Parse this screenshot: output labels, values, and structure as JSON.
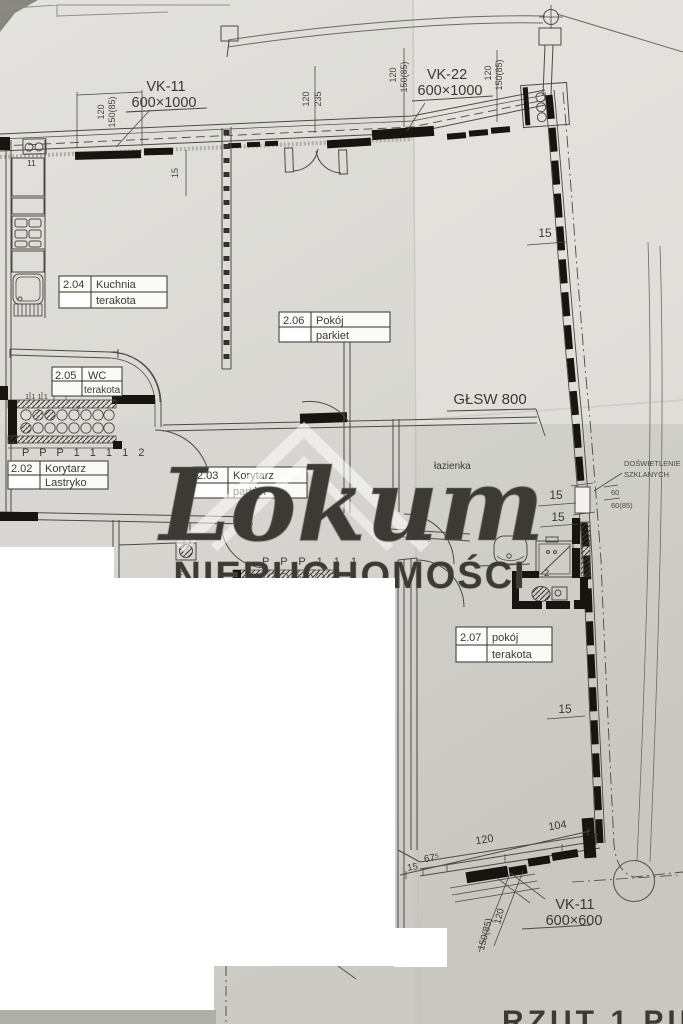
{
  "watermark": {
    "brand": "Lokum",
    "subtitle": "NIERUCHOMOŚCI"
  },
  "title": {
    "drawing_title": "RZUT 1 PIĘTRA"
  },
  "rooms": [
    {
      "id": "2.02",
      "name": "Korytarz",
      "floor": "Lastryko"
    },
    {
      "id": "2.03",
      "name": "Korytarz",
      "floor": "parkiet"
    },
    {
      "id": "2.04",
      "name": "Kuchnia",
      "floor": "terakota"
    },
    {
      "id": "2.05",
      "name": "WC",
      "floor": "terakota"
    },
    {
      "id": "2.06",
      "name": "Pokój",
      "floor": "parkiet"
    },
    {
      "id": "2.07",
      "name": "pokój",
      "floor": "terakota"
    }
  ],
  "bathroom_label": "łazienka",
  "vents": {
    "vk11_top": {
      "code": "VK-11",
      "size": "600×1000"
    },
    "vk22": {
      "code": "VK-22",
      "size": "600×1000"
    },
    "vk11_bottom": {
      "code": "VK-11",
      "size": "600×600"
    }
  },
  "annotations": {
    "glsw": "GŁSW 800",
    "daylight1": "DOŚWIETLENIE",
    "daylight2": "SZKLANYCH",
    "partial_text": "d.kl."
  },
  "dims": {
    "w120_a": "120",
    "w150_a": "150(85)",
    "w120_b": "120",
    "w235": "235",
    "w120_c": "120",
    "w150_c": "150(85)",
    "w120_d": "120",
    "w150_d": "150(85)",
    "v15_top": "15",
    "r15_1": "15",
    "r15_2": "15",
    "r15_3": "15",
    "r15_4": "15",
    "w60": "60",
    "w60_85": "60(85)",
    "b15": "15",
    "b67": "67⁵",
    "b120": "120",
    "b104": "104",
    "rot120": "120",
    "rot150": "150(85)"
  },
  "marks": {
    "m11": "11",
    "m13": "1. 3.",
    "m1111": "1  1  1  1",
    "m2_wc": "2",
    "m2_hall": "2",
    "m2_shower": "2",
    "ppp_wc": "P P P 1 1 1 1  2",
    "ppp_bath": "P P P 1 1 1"
  },
  "colors": {
    "paper": "#dad9d4",
    "ink": "#4c4a45",
    "wall_black": "#17150f",
    "redaction_white": "#ffffff"
  }
}
